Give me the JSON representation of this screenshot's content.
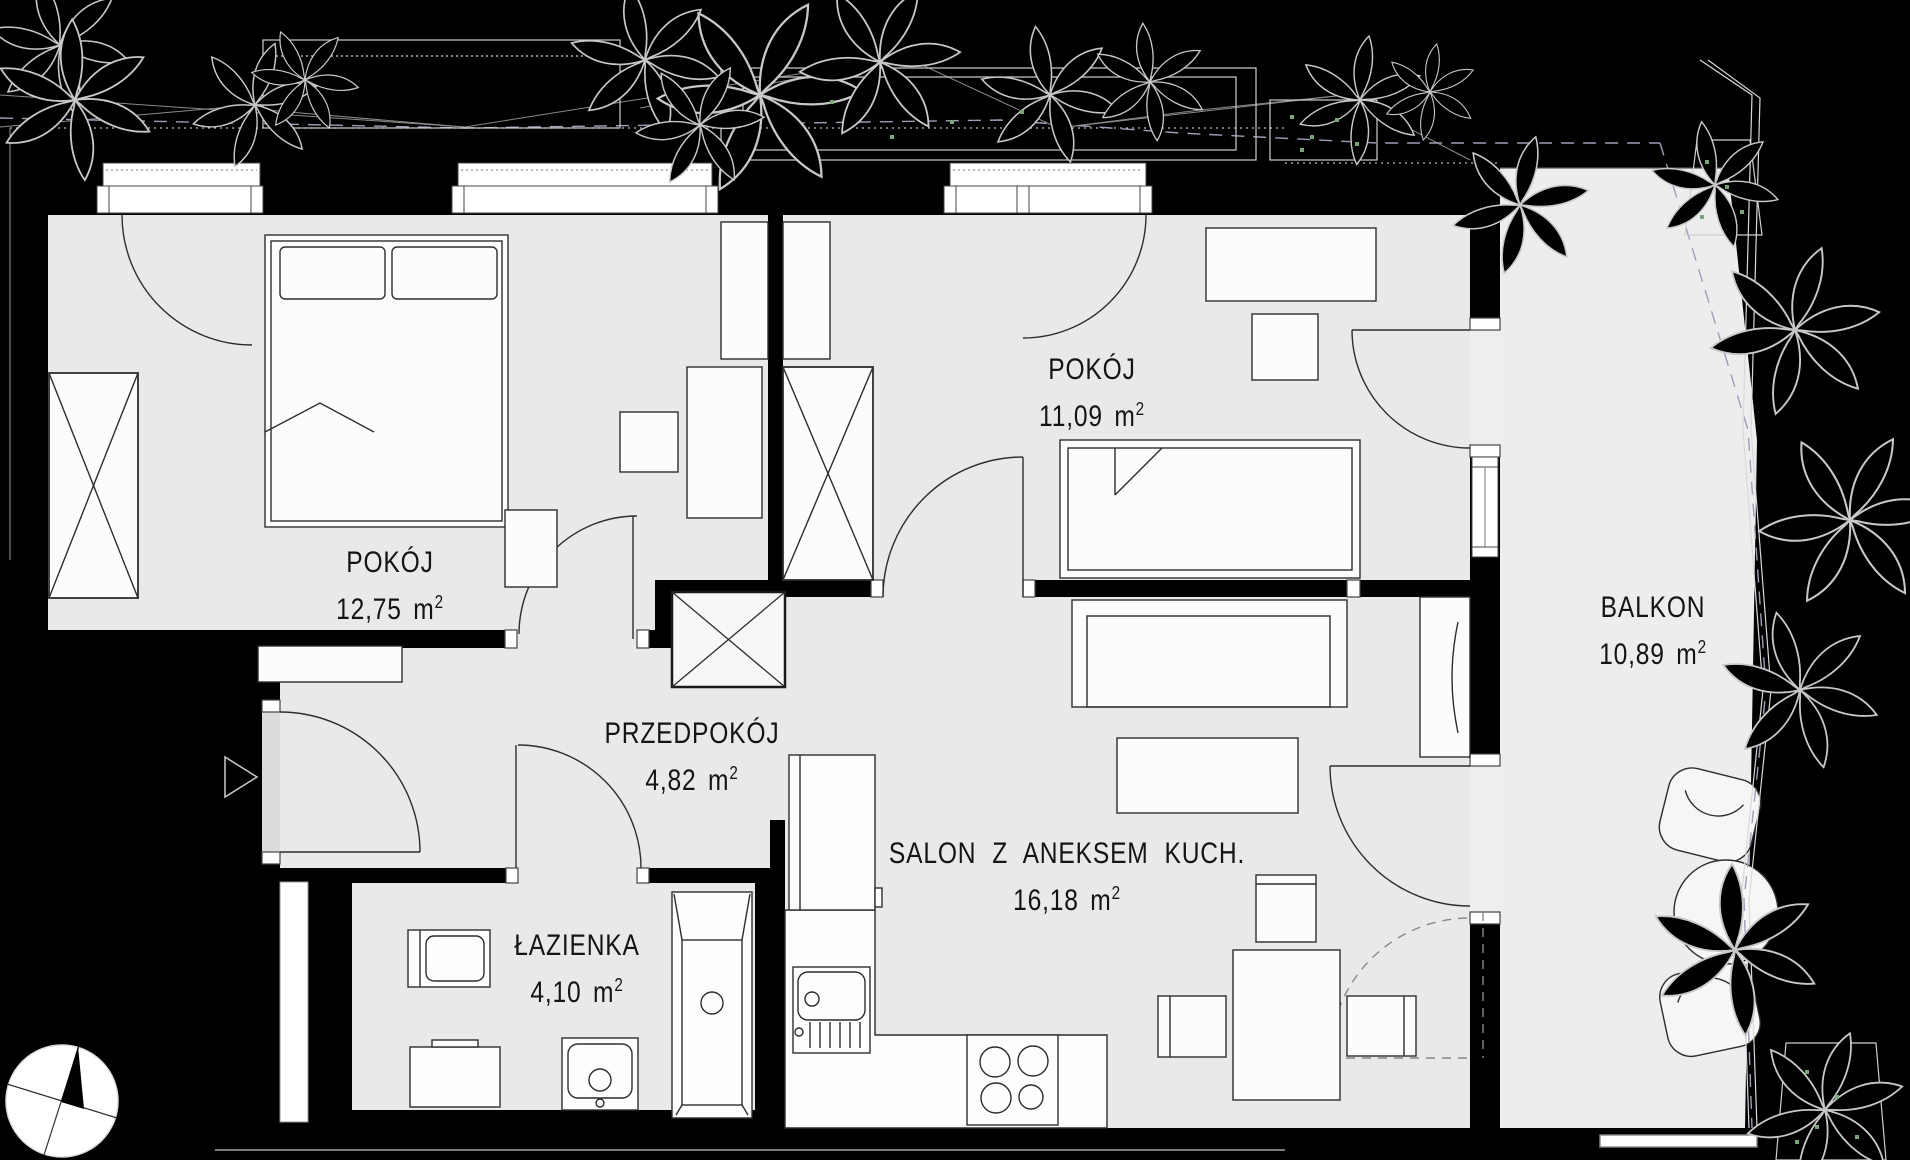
{
  "title": "apartment-floor-plan",
  "units": {
    "base": "m",
    "sup": "2"
  },
  "rooms": [
    {
      "id": "pokoj-1",
      "name": "POKÓJ",
      "area": "12,75"
    },
    {
      "id": "pokoj-2",
      "name": "POKÓJ",
      "area": "11,09"
    },
    {
      "id": "przedpokoj",
      "name": "PRZEDPOKÓJ",
      "area": "4,82"
    },
    {
      "id": "salon",
      "name": "SALON Z ANEKSEM KUCH.",
      "area": "16,18"
    },
    {
      "id": "lazienka",
      "name": "ŁAZIENKA",
      "area": "4,10"
    },
    {
      "id": "balkon",
      "name": "BALKON",
      "area": "10,89"
    }
  ],
  "colors": {
    "background": "#000000",
    "floor": "#e9e9e9",
    "balcony_floor": "#ededed",
    "wall": "#000000",
    "furniture_line": "#2d2d2d",
    "boundary_dash": "#9aa0b8",
    "plant_line": "#c8c8c8",
    "plant_green": "#7aa77a",
    "label_text": "#141414"
  }
}
